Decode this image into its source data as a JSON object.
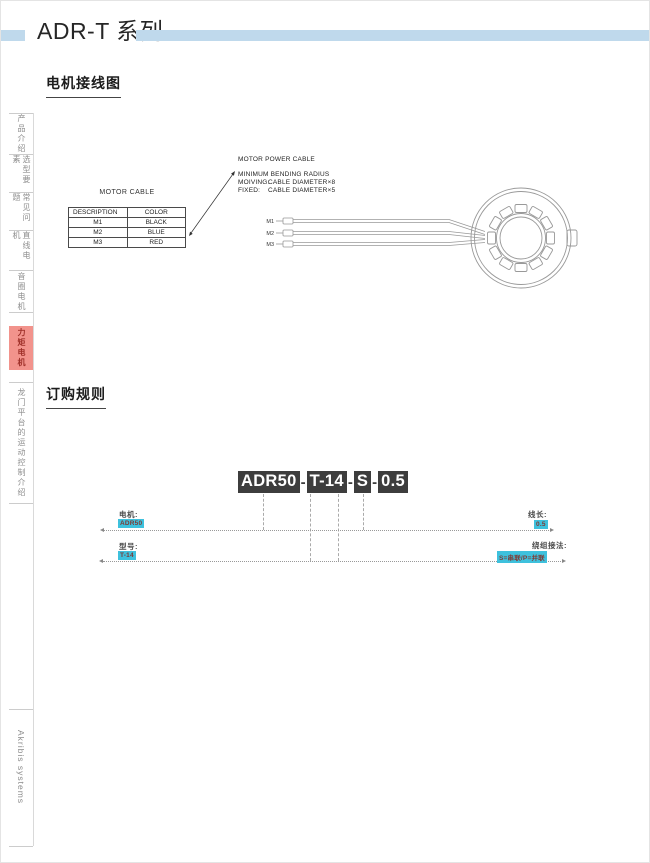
{
  "header": {
    "title": "ADR-T 系列"
  },
  "sidebar": {
    "tabs": [
      {
        "label": "产品介绍",
        "active": false
      },
      {
        "label": "选型要素",
        "active": false
      },
      {
        "label": "常见问题",
        "active": false
      },
      {
        "label": "直线电机",
        "active": false
      },
      {
        "label": "音圈电机",
        "active": false
      },
      {
        "label": "力矩电机",
        "active": true
      },
      {
        "label": "龙门平台的运动控制介绍",
        "active": false
      }
    ],
    "footer_brand": "Akribis systems"
  },
  "wiring": {
    "heading": "电机接线图",
    "table": {
      "title": "MOTOR CABLE",
      "headers": [
        "DESCRIPTION",
        "COLOR"
      ],
      "rows": [
        [
          "M1",
          "BLACK"
        ],
        [
          "M2",
          "BLUE"
        ],
        [
          "M3",
          "RED"
        ]
      ]
    },
    "notes": {
      "title": "MOTOR POWER CABLE",
      "subtitle": "MINIMUM BENDING RADIUS",
      "moving_label": "MOIVING:",
      "moving_value": "CABLE DIAMETER×8",
      "fixed_label": "FIXED:",
      "fixed_value": "CABLE DIAMETER×5"
    },
    "cable_labels": [
      "M1",
      "M2",
      "M3"
    ]
  },
  "ordering": {
    "heading": "订购规则",
    "separator": "-",
    "code_segments": [
      "ADR50",
      "T-14",
      "S",
      "0.5"
    ],
    "callouts": {
      "motor": {
        "label": "电机:",
        "value": "ADR50"
      },
      "model": {
        "label": "型号:",
        "value": "T-14"
      },
      "cable_length": {
        "label": "线长:",
        "value": "0.5"
      },
      "winding": {
        "label": "绕组接法:",
        "value": "S=串联/P=并联"
      }
    }
  },
  "colors": {
    "header_bar": "#BFD9EC",
    "active_tab_bg": "#F2938C",
    "active_tab_text": "#9E2F28",
    "badge_bg": "#3EC1DD",
    "badge_text": "#7E3B35",
    "code_bg": "#3D3D3D"
  }
}
